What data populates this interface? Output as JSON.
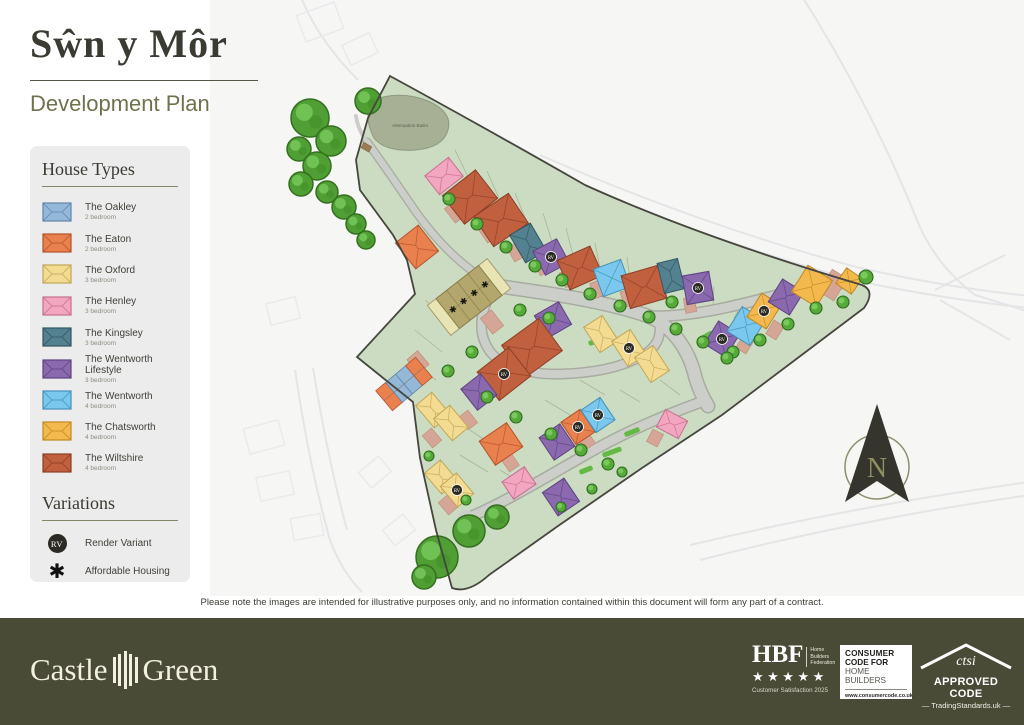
{
  "header": {
    "title": "Sŵn y Môr",
    "subtitle": "Development Plan"
  },
  "legend": {
    "house_types_title": "House Types",
    "house_types": [
      {
        "key": "oakley",
        "name": "The Oakley",
        "bedrooms": "2 bedroom"
      },
      {
        "key": "eaton",
        "name": "The Eaton",
        "bedrooms": "2 bedroom"
      },
      {
        "key": "oxford",
        "name": "The Oxford",
        "bedrooms": "3 bedroom"
      },
      {
        "key": "henley",
        "name": "The Henley",
        "bedrooms": "3 bedroom"
      },
      {
        "key": "kingsley",
        "name": "The Kingsley",
        "bedrooms": "3 bedroom"
      },
      {
        "key": "wentworth_lifestyle",
        "name": "The Wentworth Lifestyle",
        "bedrooms": "3 bedroom"
      },
      {
        "key": "wentworth",
        "name": "The Wentworth",
        "bedrooms": "4 bedroom"
      },
      {
        "key": "chatsworth",
        "name": "The Chatsworth",
        "bedrooms": "4 bedroom"
      },
      {
        "key": "wiltshire",
        "name": "The Wiltshire",
        "bedrooms": "4 bedroom"
      }
    ],
    "variations_title": "Variations",
    "variations": [
      {
        "symbol": "RV",
        "label": "Render Variant"
      },
      {
        "symbol": "✱",
        "label": "Affordable Housing"
      }
    ]
  },
  "plan": {
    "basin_label": "Attenuation Basin",
    "compass_label": "N",
    "palette": {
      "oakley": {
        "f": "#94b8d8",
        "s": "#5f87ab"
      },
      "eaton": {
        "f": "#e9814f",
        "s": "#b5532a"
      },
      "oxford": {
        "f": "#f3dc92",
        "s": "#c0a656"
      },
      "henley": {
        "f": "#f2a6c0",
        "s": "#c66f8e"
      },
      "kingsley": {
        "f": "#53818f",
        "s": "#315660"
      },
      "wentworth_lifestyle": {
        "f": "#8a69ae",
        "s": "#5f4382"
      },
      "wentworth": {
        "f": "#7ac8ee",
        "s": "#4590b8"
      },
      "chatsworth": {
        "f": "#f3b94e",
        "s": "#c08822"
      },
      "wiltshire": {
        "f": "#c1603f",
        "s": "#8c3f26"
      },
      "affordable": {
        "f": "#b3a76d",
        "s": "#8a7f4c"
      },
      "affordable_end": {
        "f": "#e9e4b4",
        "s": "#a79f6e"
      }
    },
    "site_fill": "#ccdcc2",
    "site_stroke": "#46463e",
    "road_fill": "#ccceca",
    "road_edge": "#a8ab9f",
    "rv_badge": {
      "bg": "#2b2b24",
      "fg": "#ffffff",
      "text": "RV"
    },
    "houses": [
      [
        "henley",
        444,
        176,
        30,
        24,
        -38
      ],
      [
        "wiltshire",
        470,
        197,
        42,
        36,
        -38
      ],
      [
        "wiltshire",
        501,
        220,
        42,
        36,
        -34
      ],
      [
        "kingsley",
        528,
        243,
        24,
        32,
        -30
      ],
      [
        "wentworth_lifestyle",
        551,
        257,
        27,
        27,
        -28,
        "rv"
      ],
      [
        "wiltshire",
        580,
        268,
        36,
        32,
        -24
      ],
      [
        "wentworth",
        612,
        278,
        29,
        29,
        -20
      ],
      [
        "wiltshire",
        644,
        287,
        38,
        34,
        -16
      ],
      [
        "kingsley",
        671,
        276,
        21,
        31,
        -14
      ],
      [
        "wentworth_lifestyle",
        698,
        288,
        27,
        29,
        -10,
        "rv"
      ],
      [
        "wentworth_lifestyle",
        722,
        339,
        25,
        27,
        32,
        "rv"
      ],
      [
        "wentworth",
        746,
        326,
        27,
        29,
        32
      ],
      [
        "chatsworth",
        764,
        311,
        23,
        28,
        32,
        "rv"
      ],
      [
        "wentworth_lifestyle",
        786,
        297,
        25,
        27,
        32
      ],
      [
        "chatsworth",
        812,
        286,
        29,
        31,
        32
      ],
      [
        "chatsworth",
        849,
        281,
        19,
        19,
        35
      ],
      [
        "eaton",
        417,
        247,
        29,
        33,
        -38
      ],
      [
        "wentworth_lifestyle",
        553,
        320,
        28,
        26,
        -30
      ],
      [
        "wiltshire",
        532,
        348,
        46,
        40,
        -36
      ],
      [
        "wiltshire",
        504,
        374,
        40,
        36,
        -38,
        "rv"
      ],
      [
        "wentworth_lifestyle",
        479,
        392,
        25,
        27,
        -38
      ],
      [
        "oxford",
        601,
        334,
        22,
        30,
        -33
      ],
      [
        "oxford",
        629,
        348,
        22,
        30,
        -33,
        "rv"
      ],
      [
        "oxford",
        652,
        364,
        22,
        30,
        -33
      ],
      [
        "oxford",
        433,
        410,
        21,
        29,
        -40
      ],
      [
        "oxford",
        451,
        423,
        21,
        29,
        -40
      ],
      [
        "eaton",
        501,
        444,
        33,
        29,
        -34
      ],
      [
        "oxford",
        441,
        477,
        21,
        27,
        -40
      ],
      [
        "oxford",
        457,
        490,
        21,
        27,
        -40,
        "rv"
      ],
      [
        "henley",
        519,
        483,
        27,
        21,
        -34
      ],
      [
        "wentworth_lifestyle",
        557,
        442,
        25,
        27,
        -34
      ],
      [
        "eaton",
        578,
        427,
        23,
        27,
        -34,
        "rv"
      ],
      [
        "wentworth",
        598,
        415,
        23,
        27,
        -34,
        "rv"
      ],
      [
        "wentworth_lifestyle",
        561,
        497,
        26,
        28,
        -34
      ],
      [
        "henley",
        672,
        424,
        25,
        20,
        28
      ]
    ],
    "affordable_terrace": {
      "x": 469,
      "y": 297,
      "rot": -38,
      "unit_w": 13.5,
      "units": 4,
      "end_w": 11,
      "h": 38
    },
    "west_terrace": {
      "x": 404,
      "y": 384,
      "rot": -40,
      "unit_w": 13,
      "h": 26,
      "colors": [
        "eaton",
        "oakley",
        "oakley",
        "eaton"
      ]
    },
    "driveways": [
      [
        455,
        212,
        13,
        18,
        -38
      ],
      [
        488,
        232,
        13,
        18,
        -34
      ],
      [
        516,
        252,
        12,
        16,
        -30
      ],
      [
        542,
        266,
        12,
        16,
        -28
      ],
      [
        568,
        278,
        12,
        16,
        -24
      ],
      [
        598,
        289,
        12,
        16,
        -20
      ],
      [
        628,
        298,
        12,
        16,
        -16
      ],
      [
        690,
        305,
        11,
        15,
        -10
      ],
      [
        833,
        285,
        18,
        26,
        32
      ],
      [
        775,
        330,
        12,
        16,
        32
      ],
      [
        745,
        344,
        12,
        16,
        32
      ],
      [
        492,
        322,
        14,
        20,
        -38
      ],
      [
        418,
        362,
        14,
        18,
        -40
      ],
      [
        432,
        438,
        12,
        16,
        -40
      ],
      [
        468,
        420,
        12,
        16,
        -38
      ],
      [
        510,
        462,
        12,
        16,
        -34
      ],
      [
        586,
        440,
        12,
        16,
        -34
      ],
      [
        448,
        505,
        12,
        16,
        -40
      ],
      [
        655,
        438,
        12,
        14,
        28
      ]
    ],
    "verges": [
      [
        600,
        340,
        24,
        5,
        -18
      ],
      [
        648,
        357,
        18,
        5,
        -14
      ],
      [
        706,
        336,
        14,
        5,
        -30
      ],
      [
        612,
        452,
        20,
        5,
        -20
      ],
      [
        632,
        432,
        16,
        5,
        -22
      ],
      [
        586,
        470,
        14,
        5,
        -22
      ]
    ],
    "trees_big": [
      [
        310,
        118,
        19
      ],
      [
        331,
        141,
        15
      ],
      [
        299,
        149,
        12
      ],
      [
        317,
        166,
        14
      ],
      [
        301,
        184,
        12
      ],
      [
        327,
        192,
        11
      ],
      [
        344,
        207,
        12
      ],
      [
        356,
        224,
        10
      ],
      [
        366,
        240,
        9
      ],
      [
        368,
        101,
        13
      ],
      [
        437,
        557,
        21
      ],
      [
        469,
        531,
        16
      ],
      [
        497,
        517,
        12
      ],
      [
        424,
        577,
        12
      ]
    ],
    "trees_small": [
      [
        449,
        199,
        6
      ],
      [
        477,
        224,
        6
      ],
      [
        506,
        247,
        6
      ],
      [
        535,
        266,
        6
      ],
      [
        562,
        280,
        6
      ],
      [
        590,
        294,
        6
      ],
      [
        620,
        306,
        6
      ],
      [
        649,
        317,
        6
      ],
      [
        676,
        329,
        6
      ],
      [
        703,
        342,
        6
      ],
      [
        733,
        352,
        6
      ],
      [
        760,
        340,
        6
      ],
      [
        788,
        324,
        6
      ],
      [
        816,
        308,
        6
      ],
      [
        843,
        302,
        6
      ],
      [
        866,
        277,
        7
      ],
      [
        672,
        302,
        6
      ],
      [
        727,
        358,
        6
      ],
      [
        520,
        310,
        6
      ],
      [
        549,
        318,
        6
      ],
      [
        472,
        352,
        6
      ],
      [
        448,
        371,
        6
      ],
      [
        487,
        397,
        6
      ],
      [
        516,
        417,
        6
      ],
      [
        551,
        434,
        6
      ],
      [
        581,
        450,
        6
      ],
      [
        608,
        464,
        6
      ],
      [
        622,
        472,
        5
      ],
      [
        592,
        489,
        5
      ],
      [
        561,
        507,
        5
      ],
      [
        466,
        500,
        5
      ],
      [
        429,
        456,
        5
      ]
    ]
  },
  "disclaimer": "Please note the images are intended for illustrative purposes only, and no information contained within this document will form any part of a contract.",
  "footer": {
    "brand_part1": "Castle",
    "brand_part2": "Green",
    "hbf": {
      "name": "HBF",
      "org_lines": [
        "Home",
        "Builders",
        "Federation"
      ],
      "stars": "★★★★★",
      "caption": "Customer Satisfaction 2025"
    },
    "consumer_code": {
      "line1": "CONSUMER",
      "line2": "CODE FOR",
      "line3": "HOME BUILDERS",
      "url": "www.consumercode.co.uk"
    },
    "ctsi": {
      "name": "ctsi",
      "approved": "APPROVED CODE",
      "ts": "— TradingStandards.uk —"
    }
  }
}
